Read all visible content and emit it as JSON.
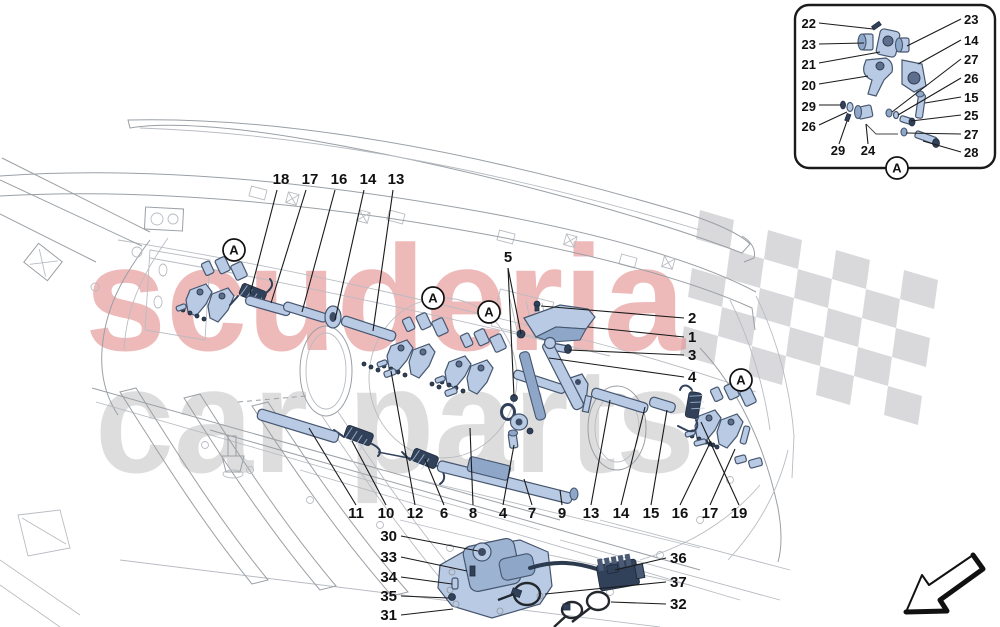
{
  "watermark": {
    "line1": "scuderia",
    "line2": "car parts"
  },
  "palette": {
    "part_fill": "#b9cbe4",
    "part_stroke": "#46566f",
    "spring_fill": "#31415a",
    "line_art": "#9aa0a6",
    "label_color": "#111111",
    "checker_gray": "#d9d9dc",
    "watermark_red": "#e58f8f",
    "watermark_gray": "#c2c2c2"
  },
  "detail_markers": [
    {
      "label": "A",
      "x": 234,
      "y": 250
    },
    {
      "label": "A",
      "x": 433,
      "y": 298
    },
    {
      "label": "A",
      "x": 489,
      "y": 312
    },
    {
      "label": "A",
      "x": 741,
      "y": 380
    },
    {
      "label": "A",
      "x": 897,
      "y": 168
    }
  ],
  "callouts": [
    {
      "t": "18",
      "x": 281,
      "y": 184,
      "leaders": [
        [
          277,
          190,
          250,
          294
        ]
      ]
    },
    {
      "t": "17",
      "x": 310,
      "y": 184,
      "leaders": [
        [
          306,
          190,
          271,
          303
        ]
      ]
    },
    {
      "t": "16",
      "x": 339,
      "y": 184,
      "leaders": [
        [
          335,
          190,
          302,
          312
        ]
      ]
    },
    {
      "t": "14",
      "x": 368,
      "y": 184,
      "leaders": [
        [
          364,
          190,
          335,
          320
        ]
      ]
    },
    {
      "t": "13",
      "x": 396,
      "y": 184,
      "leaders": [
        [
          393,
          190,
          373,
          331
        ]
      ]
    },
    {
      "t": "5",
      "x": 508,
      "y": 262,
      "leaders": [
        [
          508,
          268,
          521,
          334
        ],
        [
          508,
          268,
          514,
          396
        ]
      ]
    },
    {
      "t": "2",
      "x": 688,
      "y": 323,
      "a": "start",
      "leaders": [
        [
          684,
          318,
          541,
          306
        ]
      ]
    },
    {
      "t": "1",
      "x": 688,
      "y": 342,
      "a": "start",
      "leaders": [
        [
          684,
          337,
          588,
          327
        ]
      ]
    },
    {
      "t": "3",
      "x": 688,
      "y": 360,
      "a": "start",
      "leaders": [
        [
          684,
          355,
          569,
          350
        ]
      ]
    },
    {
      "t": "4",
      "x": 688,
      "y": 382,
      "a": "start",
      "leaders": [
        [
          684,
          377,
          549,
          358
        ]
      ]
    },
    {
      "t": "11",
      "x": 356,
      "y": 518,
      "leaders": [
        [
          356,
          505,
          309,
          428
        ]
      ]
    },
    {
      "t": "10",
      "x": 386,
      "y": 518,
      "leaders": [
        [
          386,
          505,
          352,
          441
        ]
      ]
    },
    {
      "t": "12",
      "x": 415,
      "y": 518,
      "leaders": [
        [
          415,
          505,
          391,
          371
        ]
      ]
    },
    {
      "t": "6",
      "x": 444,
      "y": 518,
      "leaders": [
        [
          444,
          505,
          425,
          459
        ]
      ]
    },
    {
      "t": "8",
      "x": 473,
      "y": 518,
      "leaders": [
        [
          473,
          505,
          470,
          428
        ]
      ]
    },
    {
      "t": "4",
      "x": 503,
      "y": 518,
      "leaders": [
        [
          503,
          505,
          514,
          445
        ]
      ]
    },
    {
      "t": "7",
      "x": 532,
      "y": 518,
      "leaders": [
        [
          532,
          505,
          524,
          479
        ]
      ]
    },
    {
      "t": "9",
      "x": 562,
      "y": 518,
      "leaders": [
        [
          562,
          505,
          560,
          490
        ]
      ]
    },
    {
      "t": "13",
      "x": 591,
      "y": 518,
      "leaders": [
        [
          591,
          505,
          610,
          400
        ]
      ]
    },
    {
      "t": "14",
      "x": 621,
      "y": 518,
      "leaders": [
        [
          621,
          505,
          645,
          407
        ]
      ]
    },
    {
      "t": "15",
      "x": 651,
      "y": 518,
      "leaders": [
        [
          651,
          505,
          667,
          410
        ]
      ]
    },
    {
      "t": "16",
      "x": 680,
      "y": 518,
      "leaders": [
        [
          680,
          505,
          711,
          441
        ]
      ]
    },
    {
      "t": "17",
      "x": 710,
      "y": 518,
      "leaders": [
        [
          710,
          505,
          735,
          449
        ]
      ]
    },
    {
      "t": "19",
      "x": 739,
      "y": 518,
      "leaders": [
        [
          739,
          505,
          701,
          422
        ]
      ]
    },
    {
      "t": "30",
      "x": 397,
      "y": 541,
      "a": "end",
      "leaders": [
        [
          401,
          536,
          478,
          551
        ]
      ]
    },
    {
      "t": "33",
      "x": 397,
      "y": 562,
      "a": "end",
      "leaders": [
        [
          401,
          557,
          467,
          571
        ]
      ]
    },
    {
      "t": "34",
      "x": 397,
      "y": 582,
      "a": "end",
      "leaders": [
        [
          401,
          577,
          452,
          584
        ]
      ]
    },
    {
      "t": "35",
      "x": 397,
      "y": 601,
      "a": "end",
      "leaders": [
        [
          401,
          596,
          449,
          598
        ]
      ]
    },
    {
      "t": "31",
      "x": 397,
      "y": 620,
      "a": "end",
      "leaders": [
        [
          401,
          615,
          453,
          609
        ]
      ]
    },
    {
      "t": "36",
      "x": 670,
      "y": 563,
      "a": "start",
      "leaders": [
        [
          666,
          558,
          615,
          570
        ]
      ]
    },
    {
      "t": "37",
      "x": 670,
      "y": 587,
      "a": "start",
      "leaders": [
        [
          666,
          582,
          545,
          594
        ]
      ]
    },
    {
      "t": "32",
      "x": 670,
      "y": 609,
      "a": "start",
      "leaders": [
        [
          666,
          604,
          611,
          602
        ]
      ]
    },
    {
      "t": "22",
      "x": 816,
      "y": 28,
      "a": "end",
      "fs": 13,
      "leaders": [
        [
          819,
          23,
          873,
          29
        ]
      ]
    },
    {
      "t": "23",
      "x": 816,
      "y": 49,
      "a": "end",
      "fs": 13,
      "leaders": [
        [
          819,
          44,
          864,
          43
        ]
      ]
    },
    {
      "t": "21",
      "x": 816,
      "y": 69,
      "a": "end",
      "fs": 13,
      "leaders": [
        [
          819,
          63,
          880,
          52
        ]
      ]
    },
    {
      "t": "20",
      "x": 816,
      "y": 90,
      "a": "end",
      "fs": 13,
      "leaders": [
        [
          819,
          84,
          868,
          76
        ]
      ]
    },
    {
      "t": "29",
      "x": 816,
      "y": 111,
      "a": "end",
      "fs": 13,
      "leaders": [
        [
          819,
          105,
          841,
          105
        ]
      ]
    },
    {
      "t": "26",
      "x": 816,
      "y": 131,
      "a": "end",
      "fs": 13,
      "leaders": [
        [
          819,
          125,
          847,
          112
        ]
      ]
    },
    {
      "t": "29",
      "x": 838,
      "y": 155,
      "fs": 13,
      "leaders": [
        [
          839,
          144,
          847,
          121
        ]
      ]
    },
    {
      "t": "24",
      "x": 868,
      "y": 155,
      "fs": 13,
      "leaders": [
        [
          868,
          144,
          866,
          124
        ]
      ]
    },
    {
      "t": "23",
      "x": 964,
      "y": 24,
      "a": "start",
      "fs": 13,
      "leaders": [
        [
          961,
          19,
          907,
          46
        ]
      ]
    },
    {
      "t": "14",
      "x": 964,
      "y": 45,
      "a": "start",
      "fs": 13,
      "leaders": [
        [
          961,
          40,
          918,
          64
        ]
      ]
    },
    {
      "t": "27",
      "x": 964,
      "y": 64,
      "a": "start",
      "fs": 13,
      "leaders": [
        [
          961,
          59,
          892,
          112
        ]
      ]
    },
    {
      "t": "26",
      "x": 964,
      "y": 83,
      "a": "start",
      "fs": 13,
      "leaders": [
        [
          961,
          78,
          898,
          115
        ]
      ]
    },
    {
      "t": "15",
      "x": 964,
      "y": 102,
      "a": "start",
      "fs": 13,
      "leaders": [
        [
          961,
          97,
          925,
          103
        ]
      ]
    },
    {
      "t": "25",
      "x": 964,
      "y": 120,
      "a": "start",
      "fs": 13,
      "leaders": [
        [
          961,
          115,
          911,
          121
        ]
      ]
    },
    {
      "t": "27",
      "x": 964,
      "y": 139,
      "a": "start",
      "fs": 13,
      "leaders": [
        [
          961,
          134,
          906,
          133
        ]
      ]
    },
    {
      "t": "28",
      "x": 964,
      "y": 157,
      "a": "start",
      "fs": 13,
      "leaders": [
        [
          961,
          152,
          923,
          141
        ]
      ]
    }
  ]
}
